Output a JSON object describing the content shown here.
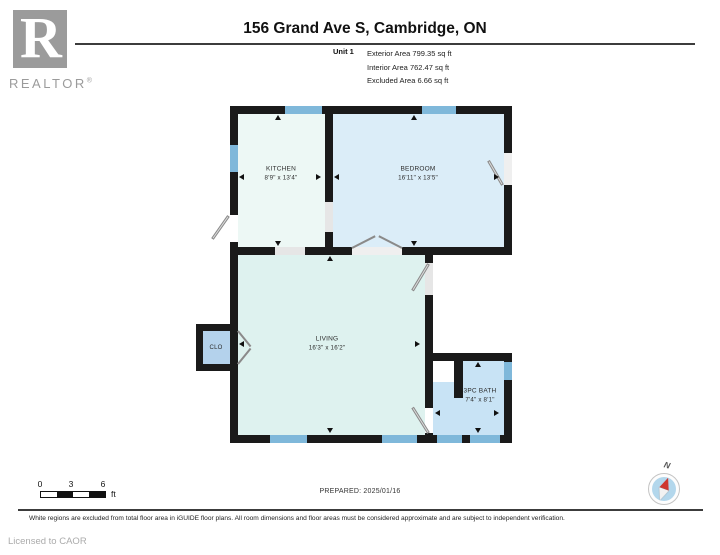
{
  "header": {
    "logo": {
      "letter": "R",
      "wordmark": "REALTOR",
      "registered": "®"
    },
    "title": "156 Grand Ave S, Cambridge, ON",
    "unit": {
      "label": "Unit 1",
      "exterior": "Exterior Area 799.35 sq ft",
      "interior": "Interior Area 762.47 sq ft",
      "excluded": "Excluded Area 6.66 sq ft"
    }
  },
  "rooms": {
    "kitchen": {
      "name": "KITCHEN",
      "dims": "8'9\" x 13'4\""
    },
    "bedroom": {
      "name": "BEDROOM",
      "dims": "16'11\" x 13'5\""
    },
    "living": {
      "name": "LIVING",
      "dims": "16'3\" x 16'2\""
    },
    "closet": {
      "name": "CLO"
    },
    "bath": {
      "name": "3PC BATH",
      "dims": "7'4\" x 8'1\""
    }
  },
  "footer": {
    "scale": {
      "tick0": "0",
      "tick1": "3",
      "tick2": "6",
      "unit": "ft"
    },
    "prepared": "PREPARED: 2025/01/16",
    "compass": {
      "north": "N"
    },
    "disclaimer": "White regions are excluded from total floor area in iGUIDE floor plans. All room dimensions and floor areas must be considered approximate and are subject to independent verification.",
    "license": "Licensed to CAOR"
  },
  "colors": {
    "wall": "#1a1a1a",
    "window": "#7fb8da",
    "kitchen_fill": "#edf8f5",
    "bedroom_fill": "#dbedf8",
    "living_fill": "#def2ef",
    "closet_fill": "#b4d2ec",
    "bath_fill": "#c8e3f5",
    "excluded_fill": "#ffffff",
    "door_leaf": "#dcdcdc",
    "compass_needle_red": "#cf3730",
    "logo_gray": "#9b9b9b"
  }
}
